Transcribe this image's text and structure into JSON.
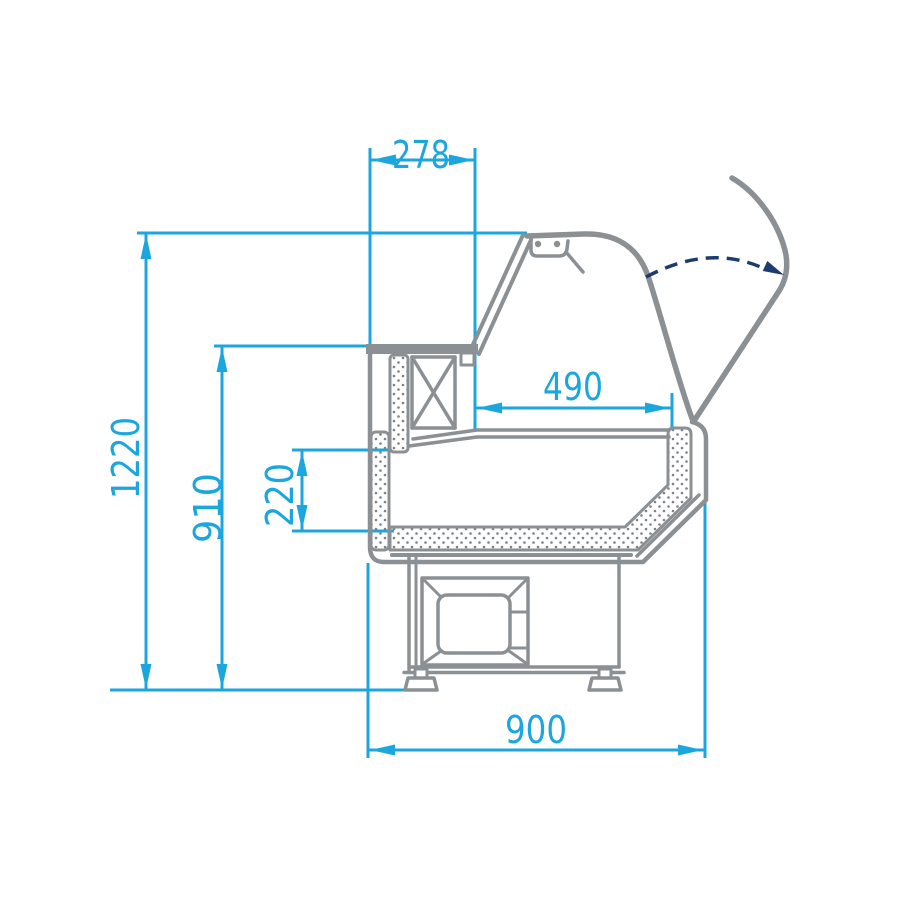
{
  "dims": {
    "d278": "278",
    "d490": "490",
    "d220": "220",
    "d910": "910",
    "d1220": "1220",
    "d900": "900"
  },
  "colors": {
    "dimension_blue": "#1CA6DE",
    "structure_gray": "#8B9094",
    "motion_navy": "#1B3C6D",
    "background": "#FFFFFF"
  }
}
